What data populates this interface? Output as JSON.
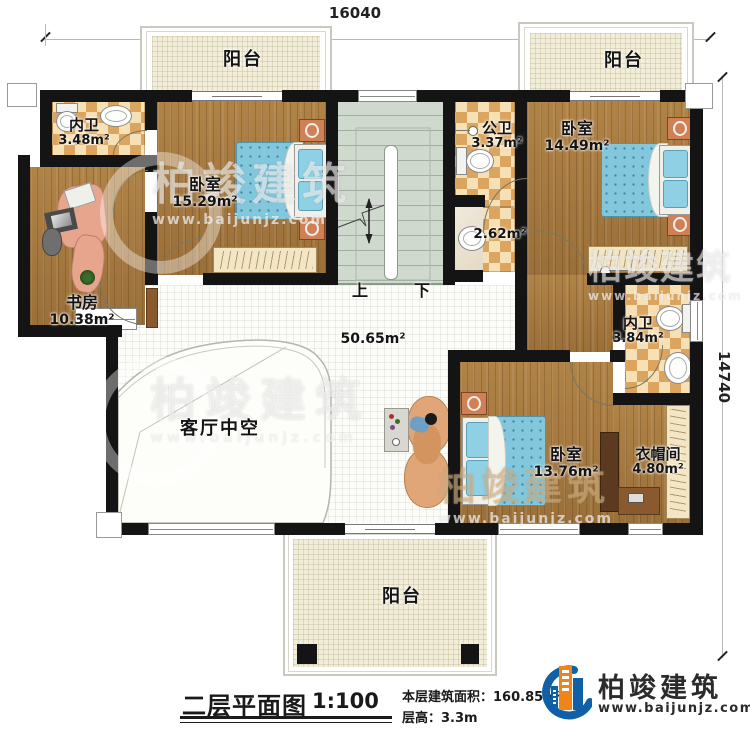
{
  "dimensions": {
    "top_width": "16040",
    "right_height": "14740"
  },
  "rooms": [
    {
      "id": "balcony-top-left",
      "name": "阳台",
      "area": ""
    },
    {
      "id": "bath-top-left",
      "name": "内卫",
      "area": "3.48m²"
    },
    {
      "id": "bedroom-top-left",
      "name": "卧室",
      "area": "15.29m²"
    },
    {
      "id": "public-bath",
      "name": "公卫",
      "area": "3.37m²"
    },
    {
      "id": "wash-area",
      "name": "",
      "area": "2.62m²"
    },
    {
      "id": "balcony-top-right",
      "name": "阳台",
      "area": ""
    },
    {
      "id": "bedroom-top-right",
      "name": "卧室",
      "area": "14.49m²"
    },
    {
      "id": "study",
      "name": "书房",
      "area": "10.38m²"
    },
    {
      "id": "bath-right",
      "name": "内卫",
      "area": "3.84m²"
    },
    {
      "id": "living-void",
      "name": "客厅中空",
      "area": "50.65m²"
    },
    {
      "id": "bedroom-bottom",
      "name": "卧室",
      "area": "13.76m²"
    },
    {
      "id": "cloakroom",
      "name": "衣帽间",
      "area": "4.80m²"
    },
    {
      "id": "balcony-bottom",
      "name": "阳台",
      "area": ""
    }
  ],
  "stairs": {
    "up": "上",
    "down": "下"
  },
  "title_block": {
    "title": "二层平面图",
    "scale": "1:100",
    "floor_area_label": "本层建筑面积：",
    "floor_area": "160.85m²",
    "floor_height_label": "层高：",
    "floor_height": "3.3m"
  },
  "logo": {
    "name": "柏竣建筑",
    "url": "www.baijunjz.com"
  },
  "watermark": {
    "brand": "柏竣建筑",
    "site": "www.baijunjz.com"
  },
  "colors": {
    "wall": "#141414",
    "wood": "#a6793f",
    "tile_dark": "#dba55f",
    "stairs": "#cfd9cd",
    "balcony": "#f2edd8",
    "brand_blue": "#1060a8",
    "brand_orange": "#f08418"
  }
}
